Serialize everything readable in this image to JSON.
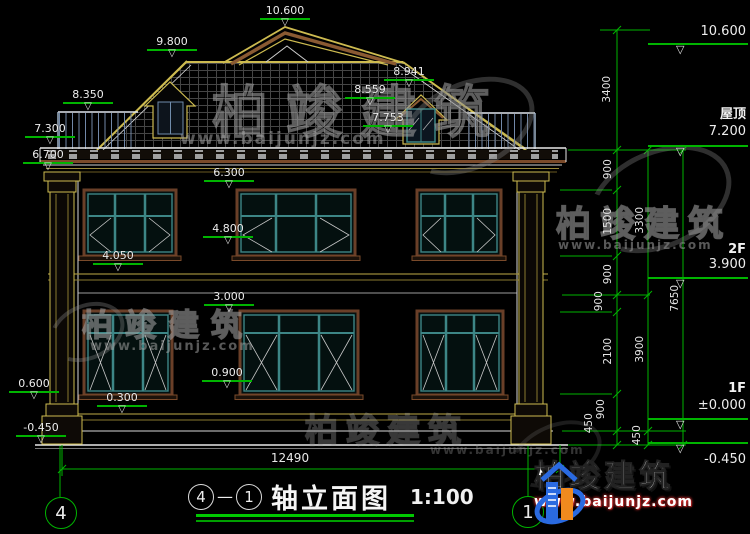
{
  "drawing": {
    "title": {
      "axis_start": "4",
      "sep": "—",
      "axis_end": "1",
      "name": "轴立面图",
      "scale": "1:100"
    },
    "axes": {
      "left": "4",
      "right": "1"
    },
    "overall_width": "12490",
    "elevation_markers": [
      {
        "value": "10.600",
        "cx": 285,
        "top": 5
      },
      {
        "value": "9.800",
        "cx": 172,
        "top": 36
      },
      {
        "value": "8.350",
        "cx": 88,
        "top": 89
      },
      {
        "value": "7.300",
        "cx": 50,
        "top": 123
      },
      {
        "value": "6.700",
        "cx": 48,
        "top": 149
      },
      {
        "value": "8.941",
        "cx": 409,
        "top": 66
      },
      {
        "value": "8.559",
        "cx": 370,
        "top": 84
      },
      {
        "value": "7.753",
        "cx": 388,
        "top": 112
      },
      {
        "value": "6.300",
        "cx": 229,
        "top": 167
      },
      {
        "value": "4.800",
        "cx": 228,
        "top": 223
      },
      {
        "value": "4.050",
        "cx": 118,
        "top": 250
      },
      {
        "value": "3.000",
        "cx": 229,
        "top": 291
      },
      {
        "value": "0.900",
        "cx": 227,
        "top": 367
      },
      {
        "value": "0.600",
        "cx": 34,
        "top": 378
      },
      {
        "value": "0.300",
        "cx": 122,
        "top": 392
      },
      {
        "value": "-0.450",
        "cx": 41,
        "top": 422
      }
    ],
    "right_markers": [
      {
        "floor": "",
        "value": "10.600",
        "floor_top": 0,
        "value_top": 24,
        "bar_y": 43,
        "below": false
      },
      {
        "floor": "屋顶",
        "value": "7.200",
        "floor_top": 103,
        "value_top": 124,
        "bar_y": 145,
        "below": false
      },
      {
        "floor": "2F",
        "value": "3.900",
        "floor_top": 242,
        "value_top": 257,
        "bar_y": 277,
        "below": false
      },
      {
        "floor": "1F",
        "value": "±0.000",
        "floor_top": 381,
        "value_top": 398,
        "bar_y": 418,
        "below": false
      },
      {
        "floor": "",
        "value": "-0.450",
        "floor_top": 0,
        "value_top": 452,
        "bar_y": 442,
        "below": true
      }
    ],
    "dim_labels": [
      {
        "value": "3400",
        "x": 607,
        "y": 90
      },
      {
        "value": "900",
        "x": 608,
        "y": 170
      },
      {
        "value": "1500",
        "x": 608,
        "y": 222
      },
      {
        "value": "900",
        "x": 608,
        "y": 275
      },
      {
        "value": "900",
        "x": 599,
        "y": 302
      },
      {
        "value": "2100",
        "x": 608,
        "y": 352
      },
      {
        "value": "900",
        "x": 601,
        "y": 410
      },
      {
        "value": "450",
        "x": 589,
        "y": 424
      },
      {
        "value": "450",
        "x": 637,
        "y": 436
      },
      {
        "value": "3300",
        "x": 640,
        "y": 221
      },
      {
        "value": "3900",
        "x": 640,
        "y": 350
      },
      {
        "value": "7650",
        "x": 675,
        "y": 299
      }
    ]
  },
  "watermarks": {
    "center": {
      "name": "柏竣建筑",
      "url": "www.baijunjz.com"
    },
    "left": {
      "name": "柏竣建筑",
      "url": "www.baijunjz.com"
    },
    "right": {
      "name": "柏竣建筑",
      "url": "www.baijunjz.com"
    },
    "bottom": {
      "name": "柏竣建筑",
      "url": "www.baijunjz.com"
    }
  },
  "logo": {
    "name": "柏竣建筑",
    "url": "www.baijunjz.com"
  },
  "colors": {
    "dim_green": "#00b400",
    "line_white": "#e8e8e8",
    "roof_yellow": "#cdbb50",
    "frame_brown": "#6a3f28",
    "window_teal": "#3d8686",
    "railing_blue": "#7288a8",
    "logo_blue": "#2a6ae0",
    "logo_orange": "#f08a1e"
  }
}
